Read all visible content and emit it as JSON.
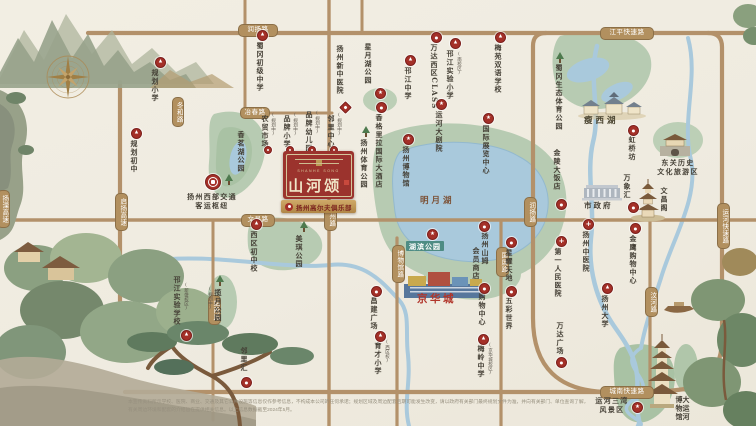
{
  "badge": {
    "name_cn": "山河颂",
    "name_en": "SHANHE SONG",
    "ribbon_label": "扬州高尔夫俱乐部",
    "color_red": "#9b332d",
    "color_cream": "#f0e5c8"
  },
  "marker_glyphs": {
    "school": "▲",
    "mall": "●",
    "hospital": "+",
    "star": "★",
    "diamond": "",
    "dot": "",
    "tree": "tree-icon",
    "transit": "train-hub-icon"
  },
  "colors": {
    "road": "#b3916a",
    "water": "#a9c9dc",
    "park": "#b7cbb2",
    "marker_red": "#a43028",
    "pill": "#b2905f",
    "teal_box": "#4e8c84",
    "highlight_red": "#b1362b"
  },
  "road_pills": [
    {
      "id": "runyang-top",
      "label": "润扬路",
      "o": "h",
      "x": 238,
      "y": 24,
      "w": 38,
      "h": 11
    },
    {
      "id": "jiangping",
      "label": "江平快速路",
      "o": "h",
      "x": 600,
      "y": 27,
      "w": 52,
      "h": 11
    },
    {
      "id": "yechun",
      "label": "冶春路",
      "o": "h",
      "x": 240,
      "y": 107,
      "w": 28,
      "h": 10
    },
    {
      "id": "donghe",
      "label": "冬和路",
      "o": "v",
      "x": 172,
      "y": 97,
      "w": 10,
      "h": 28
    },
    {
      "id": "qiyang-expwy",
      "label": "启扬高速",
      "o": "v",
      "x": 115,
      "y": 193,
      "w": 11,
      "h": 36
    },
    {
      "id": "yangli-expwy",
      "label": "扬溧高速",
      "o": "v",
      "x": -3,
      "y": 190,
      "w": 11,
      "h": 36
    },
    {
      "id": "wenchang",
      "label": "文昌路",
      "o": "h",
      "x": 241,
      "y": 214,
      "w": 32,
      "h": 11
    },
    {
      "id": "zhenzhou",
      "label": "真州路",
      "o": "v",
      "x": 324,
      "y": 201,
      "w": 11,
      "h": 28
    },
    {
      "id": "bowuguan",
      "label": "博物馆路",
      "o": "v",
      "x": 392,
      "y": 245,
      "w": 11,
      "h": 36
    },
    {
      "id": "zhannan",
      "label": "站南路",
      "o": "v",
      "x": 208,
      "y": 295,
      "w": 11,
      "h": 28
    },
    {
      "id": "guozhan",
      "label": "国展路",
      "o": "v",
      "x": 496,
      "y": 247,
      "w": 11,
      "h": 28
    },
    {
      "id": "runyang-v",
      "label": "润扬路",
      "o": "v",
      "x": 524,
      "y": 197,
      "w": 11,
      "h": 28
    },
    {
      "id": "wenhe",
      "label": "汶河路",
      "o": "v",
      "x": 645,
      "y": 287,
      "w": 11,
      "h": 28
    },
    {
      "id": "yunhe-expwy",
      "label": "运河快速路",
      "o": "v",
      "x": 717,
      "y": 203,
      "w": 11,
      "h": 44
    },
    {
      "id": "chengnan-expwy",
      "label": "城南快速路",
      "o": "h",
      "x": 600,
      "y": 386,
      "w": 52,
      "h": 11
    }
  ],
  "pois": [
    {
      "id": "guihua-xiaoxue",
      "label": "规划小学",
      "type": "school",
      "mx": 155,
      "my": 57,
      "tx": 152,
      "ty": 69
    },
    {
      "id": "shugang-middle",
      "label": "蜀冈初级中学",
      "type": "school",
      "mx": 257,
      "my": 30,
      "tx": 257,
      "ty": 42
    },
    {
      "id": "xin-tcm-hospital",
      "label": "扬州新中医院",
      "type": "diamond",
      "mx": 341,
      "my": 103,
      "tx": 337,
      "ty": 45
    },
    {
      "id": "xingyuehu-park",
      "label": "星月湖公园",
      "type": "star",
      "mx": 375,
      "my": 88,
      "tx": 365,
      "ty": 43
    },
    {
      "id": "hanjiang-highschool",
      "label": "邗江中学",
      "type": "school",
      "mx": 405,
      "my": 55,
      "tx": 405,
      "ty": 67
    },
    {
      "id": "wanda-class",
      "label": "万达西区CLASS",
      "type": "mall",
      "mx": 431,
      "my": 32,
      "tx": 431,
      "ty": 44
    },
    {
      "id": "hanjiang-exp-primary",
      "label": "邗江实验小学",
      "sub": "(南校区)",
      "type": "school",
      "mx": 450,
      "my": 38,
      "tx": 447,
      "ty": 50,
      "subx": 456,
      "suby": 52
    },
    {
      "id": "meiyuan-school",
      "label": "梅苑双语学校",
      "type": "school",
      "mx": 495,
      "my": 32,
      "tx": 495,
      "ty": 44
    },
    {
      "id": "shugang-eco-park",
      "label": "蜀冈生态体育公园",
      "type": "tree",
      "mx": 555,
      "my": 52,
      "tx": 556,
      "ty": 64
    },
    {
      "id": "guihua-middle",
      "label": "规划初中",
      "type": "school",
      "mx": 131,
      "my": 128,
      "tx": 131,
      "ty": 140
    },
    {
      "id": "west-transport-hub",
      "label": "扬州西部交通\n客运枢纽",
      "type": "transit",
      "mx": 205,
      "my": 174,
      "tx": 180,
      "ty": 192,
      "dir": "h",
      "cls": "center",
      "w": 64
    },
    {
      "id": "xiangminghu-park",
      "label": "香茗湖公园",
      "type": "tree",
      "mx": 224,
      "my": 174,
      "tx": 238,
      "ty": 131
    },
    {
      "id": "plan-market",
      "label": "农贸市场",
      "sub": "(规划中)",
      "type": "dot",
      "mx": 264,
      "my": 146,
      "tx": 262,
      "ty": 115,
      "subx": 270,
      "suby": 113
    },
    {
      "id": "plan-primary",
      "label": "品牌小学",
      "sub": "(规划中)",
      "type": "dot",
      "mx": 286,
      "my": 146,
      "tx": 284,
      "ty": 115,
      "subx": 292,
      "suby": 113
    },
    {
      "id": "plan-kindergarten",
      "label": "品牌幼儿园",
      "sub": "(规划中)",
      "type": "dot",
      "mx": 308,
      "my": 146,
      "tx": 306,
      "ty": 111,
      "subx": 314,
      "suby": 111
    },
    {
      "id": "plan-neighborhood",
      "label": "邻里中心",
      "sub": "(规划中)",
      "type": "dot",
      "mx": 330,
      "my": 146,
      "tx": 328,
      "ty": 115,
      "subx": 336,
      "suby": 113
    },
    {
      "id": "xiqu-middle",
      "label": "西区初中校",
      "type": "school",
      "mx": 251,
      "my": 219,
      "tx": 251,
      "ty": 231
    },
    {
      "id": "meiqi-park",
      "label": "美琪公园",
      "type": "tree",
      "mx": 299,
      "my": 221,
      "tx": 296,
      "ty": 235
    },
    {
      "id": "lanyue-park",
      "label": "揽月公园",
      "sub": "(规划中)",
      "type": "tree",
      "mx": 215,
      "my": 275,
      "tx": 215,
      "ty": 289,
      "subx": 207,
      "suby": 287
    },
    {
      "id": "hanjiang-exp-school",
      "label": "邗江实验学校",
      "sub": "(新盛校区)",
      "type": "school",
      "mx": 181,
      "my": 330,
      "tx": 174,
      "ty": 276,
      "subx": 183,
      "suby": 283
    },
    {
      "id": "linlihui",
      "label": "邻里汇",
      "type": "mall",
      "mx": 241,
      "my": 377,
      "tx": 241,
      "ty": 347
    },
    {
      "id": "tiyu-park",
      "label": "扬州体育公园",
      "type": "tree",
      "mx": 361,
      "my": 126,
      "tx": 361,
      "ty": 139
    },
    {
      "id": "shangrila-hotel",
      "label": "香格里拉国际大酒店",
      "type": "mall",
      "mx": 376,
      "my": 102,
      "tx": 376,
      "ty": 114
    },
    {
      "id": "yangzhou-museum",
      "label": "扬州博物馆",
      "type": "star",
      "mx": 403,
      "my": 134,
      "tx": 403,
      "ty": 146
    },
    {
      "id": "canal-grand-theatre",
      "label": "运河大剧院",
      "type": "star",
      "mx": 436,
      "my": 99,
      "tx": 436,
      "ty": 111
    },
    {
      "id": "intl-expo-center",
      "label": "国际展览中心",
      "type": "star",
      "mx": 483,
      "my": 113,
      "tx": 483,
      "ty": 125
    },
    {
      "id": "hubin-park",
      "label": "湖滨公园",
      "type": "star",
      "mx": 427,
      "my": 229,
      "tx": 406,
      "ty": 241,
      "dir": "h",
      "cls": "teal"
    },
    {
      "id": "sams-club-1",
      "label": "扬州山姆",
      "type": "mall",
      "mx": 479,
      "my": 221,
      "tx": 482,
      "ty": 232
    },
    {
      "id": "sams-club-2",
      "label": "会员商店",
      "type": "none",
      "tx": 473,
      "ty": 247
    },
    {
      "id": "shopping-center",
      "label": "购物中心",
      "type": "mall",
      "mx": 479,
      "my": 283,
      "tx": 479,
      "ty": 293
    },
    {
      "id": "meiling-middle",
      "label": "梅岭中学",
      "sub": "(京华城校区)",
      "type": "school",
      "mx": 478,
      "my": 334,
      "tx": 478,
      "ty": 345,
      "subx": 487,
      "suby": 343
    },
    {
      "id": "yucai-primary",
      "label": "育才小学",
      "sub": "(西区校)",
      "type": "school",
      "mx": 375,
      "my": 331,
      "tx": 375,
      "ty": 342,
      "subx": 384,
      "suby": 340
    },
    {
      "id": "changjian-plaza",
      "label": "昌建广场",
      "type": "mall",
      "mx": 371,
      "my": 286,
      "tx": 371,
      "ty": 297
    },
    {
      "id": "xingyao-tiandi",
      "label": "星耀天地",
      "type": "mall",
      "mx": 506,
      "my": 237,
      "tx": 506,
      "ty": 249
    },
    {
      "id": "wucai-world",
      "label": "五彩世界",
      "type": "mall",
      "mx": 506,
      "my": 286,
      "tx": 506,
      "ty": 297
    },
    {
      "id": "yangzhou-university",
      "label": "扬州大学",
      "type": "school",
      "mx": 602,
      "my": 283,
      "tx": 602,
      "ty": 295
    },
    {
      "id": "wanda-plaza",
      "label": "万达广场",
      "type": "mall",
      "mx": 556,
      "my": 357,
      "tx": 557,
      "ty": 322
    },
    {
      "id": "first-peoples-hospital",
      "label": "第一人民医院",
      "type": "hospital",
      "mx": 556,
      "my": 236,
      "tx": 555,
      "ty": 248
    },
    {
      "id": "tcm-hospital",
      "label": "扬州中医院",
      "type": "hospital",
      "mx": 583,
      "my": 219,
      "tx": 583,
      "ty": 231
    },
    {
      "id": "jinying-mall",
      "label": "金鹰购物中心",
      "type": "mall",
      "mx": 630,
      "my": 223,
      "tx": 630,
      "ty": 235
    },
    {
      "id": "jinling-hotel",
      "label": "金陵大饭店",
      "type": "mall",
      "mx": 556,
      "my": 199,
      "tx": 554,
      "ty": 149
    },
    {
      "id": "hongqiaofang",
      "label": "虹桥坊",
      "type": "mall",
      "mx": 628,
      "my": 125,
      "tx": 629,
      "ty": 136
    },
    {
      "id": "wanxianghui",
      "label": "万象汇",
      "type": "mall",
      "mx": 628,
      "my": 202,
      "tx": 624,
      "ty": 174
    },
    {
      "id": "city-government",
      "label": "市政府",
      "type": "none",
      "tx": 584,
      "ty": 202,
      "dir": "h",
      "cls": "gov"
    },
    {
      "id": "wenchangge",
      "label": "文昌阁",
      "type": "none",
      "tx": 661,
      "ty": 187
    },
    {
      "id": "dongguan-historic",
      "label": "东关历史\n文化旅游区",
      "type": "none",
      "tx": 646,
      "ty": 158,
      "dir": "h",
      "cls": "center",
      "w": 64
    },
    {
      "id": "shouxihu",
      "label": "瘦西湖",
      "type": "none",
      "tx": 584,
      "ty": 117,
      "dir": "h",
      "cls": "area"
    },
    {
      "id": "mingyuehu",
      "label": "明月湖",
      "type": "none",
      "tx": 420,
      "ty": 197,
      "dir": "h",
      "cls": "area brown"
    },
    {
      "id": "jinghuacheng",
      "label": "京华城",
      "type": "none",
      "tx": 417,
      "ty": 294,
      "dir": "h",
      "cls": "red-big"
    },
    {
      "id": "grand-canal-museum",
      "label": "大运河博物馆",
      "type": "none",
      "tx": 676,
      "ty": 396,
      "cls": "v2"
    },
    {
      "id": "sanwan-scenic",
      "label": "运河三湾\n风景区",
      "type": "star",
      "mx": 632,
      "my": 402,
      "tx": 590,
      "ty": 396,
      "dir": "h",
      "cls": "center",
      "w": 44
    }
  ],
  "disclaimer": {
    "line1": "本宣传资料所示学校、医院、商业、交通及其它公共设施等信息仅作参考信息，不构成本公司的任何承诺；规划区域及周边配套后期可能发生改变，请以政府有关部门最终规划文件为准，并向有关部门、单位查询了解，",
    "line2": "有关周边环境和配套的介绍旨在提供相关信息。以上信息数据截至2024年5月。"
  }
}
